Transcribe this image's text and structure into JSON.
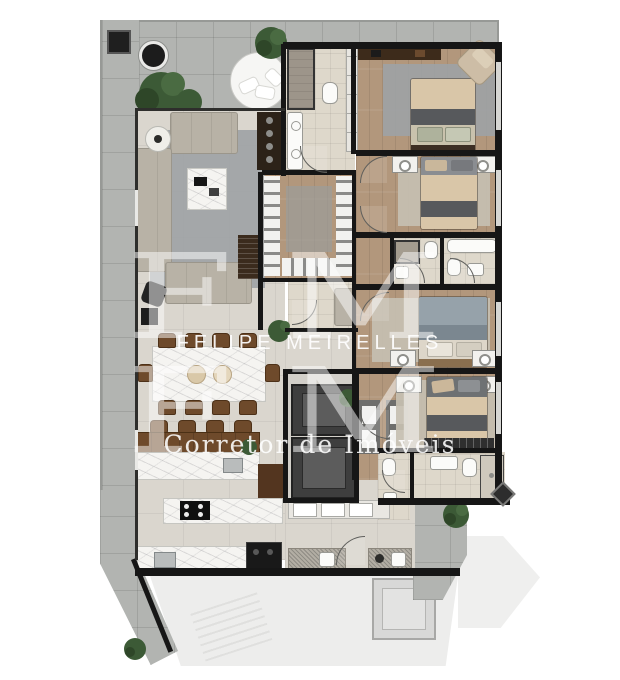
{
  "watermark": {
    "monogram_top": "FM",
    "brand_name": "FELIPE MEIRELLES",
    "monogram_bottom": "FM",
    "tagline": "Corretor de Imóveis"
  },
  "palette": {
    "wall": "#161616",
    "terrace": "#b2b4b1",
    "social": "#dad6ce",
    "wood": "#b2977c",
    "bathtile": "#ded8cb",
    "marble": "#f5f4f1",
    "granite": "#b3aea4",
    "sofa": "#b8b2a6",
    "rug": "#9da2a5",
    "rugwarm": "#c6bfb1",
    "woodfurn": "#6e4a2b",
    "wooddark": "#3b2b1d",
    "linen": "#d9c6a8",
    "throw": "#57595c",
    "bluelinen": "#96a2aa",
    "plant": "#3c5a36",
    "elevator": "#3e3e3e",
    "neighbor": "#ededec",
    "fixture": "#fbfbf9",
    "appliance": "#191919",
    "watermark": "#ffffff"
  }
}
